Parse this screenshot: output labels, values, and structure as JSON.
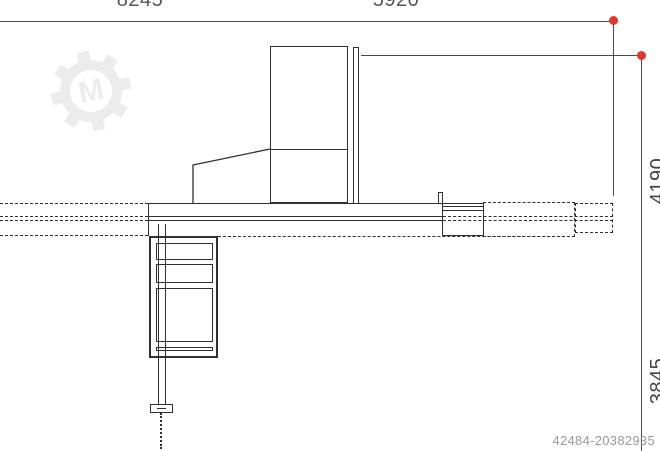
{
  "drawing": {
    "dim_labels": {
      "top_left": "8245",
      "top_mid": "5920",
      "right_upper": "4190",
      "right_lower": "3845"
    },
    "watermark_id": "42484-20382935",
    "logo_letter": "M"
  },
  "colors": {
    "marker": "#e2382b",
    "line": "#2f2f2f",
    "dim_line": "#4a4a4a",
    "dim_text": "#555555",
    "rot_text": "#444444",
    "id_text": "#9a9a9a",
    "logo": "#ececec"
  }
}
